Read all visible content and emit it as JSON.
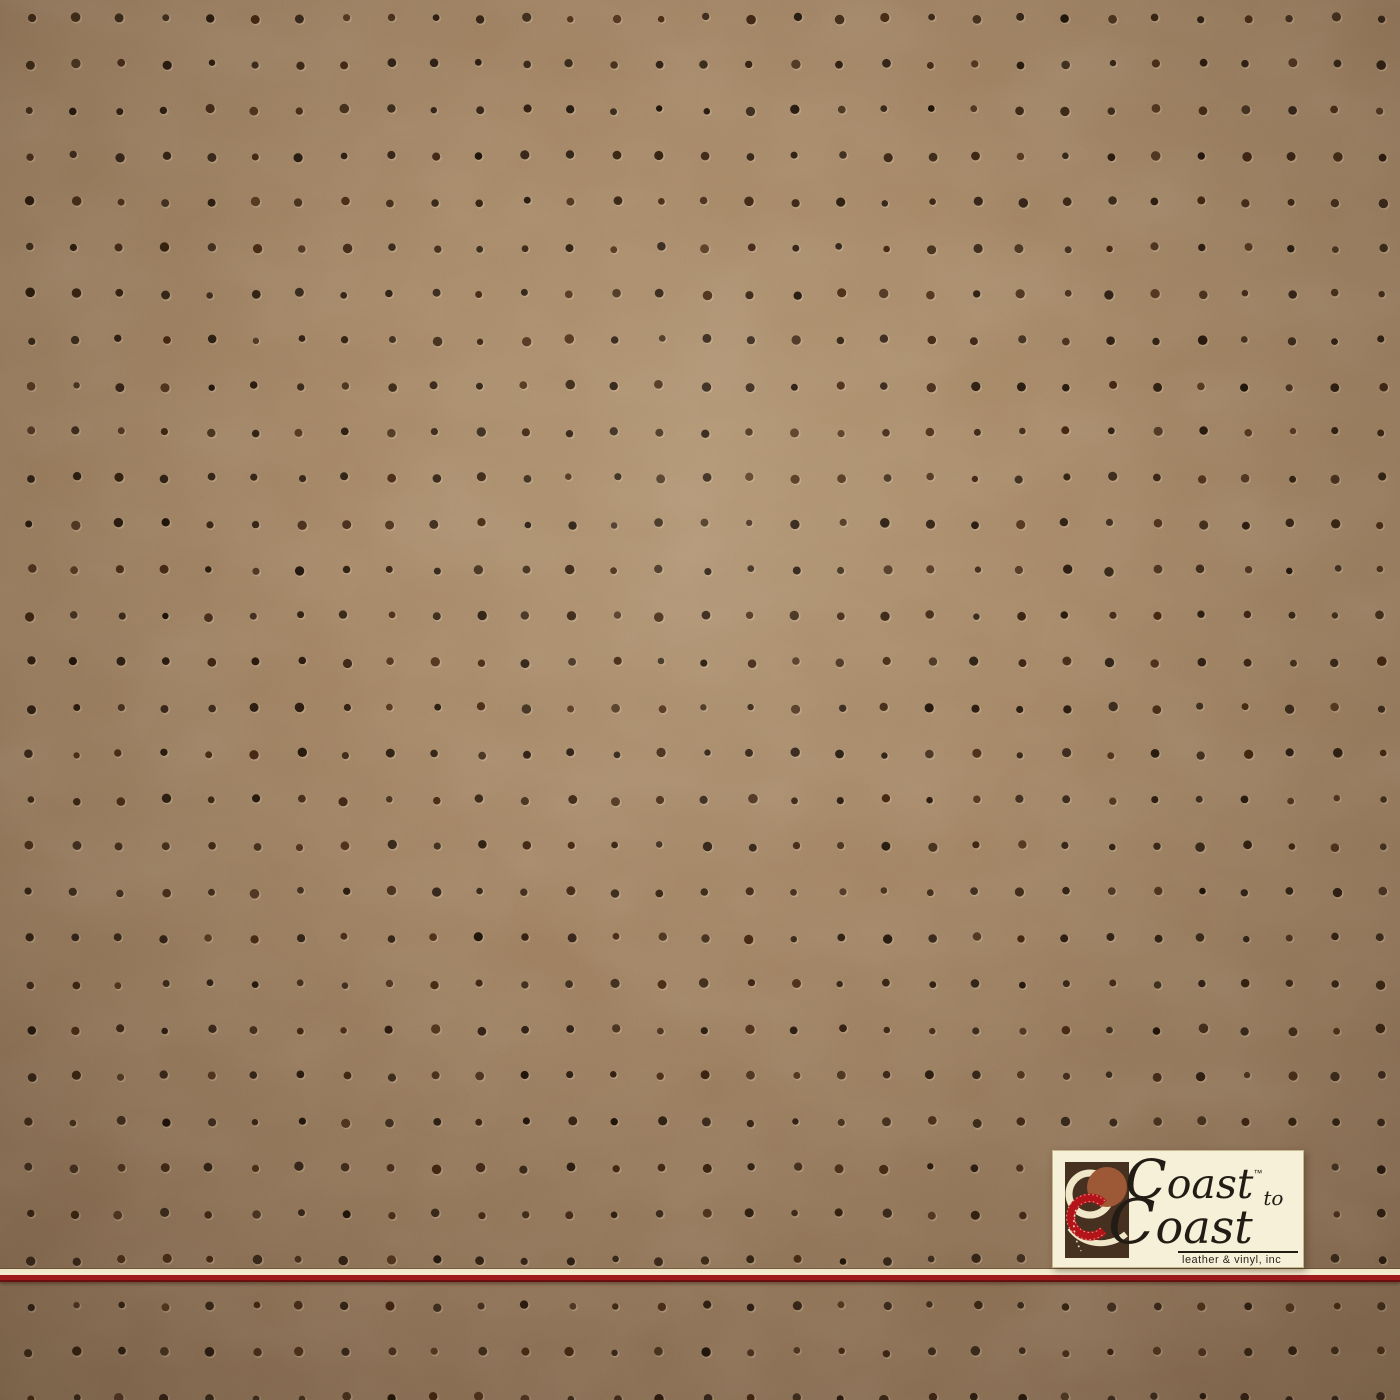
{
  "meta": {
    "description": "Product photograph of a perforated vinyl upholstery swatch: tan saddle-brown material with a regular square grid of small dark punched holes, a cream-and-red divider stripe near the bottom, and a Coast to Coast leather & vinyl, inc logo plate in the lower right corner."
  },
  "swatch": {
    "base_color": "#9d7f60",
    "highlight_color": "#a98b68",
    "mid_color": "#8f7256",
    "shadow_color": "#806549",
    "perforation": {
      "dot_color": "#281a0d",
      "dot_alt_colors": [
        "#1f1309",
        "#33200f",
        "#3c2412",
        "#2b1c10",
        "#42250f"
      ],
      "highlight_ring_color": "rgba(228,206,178,0.32)",
      "rows": 31,
      "cols": 31,
      "origin_x": 30,
      "origin_y": 18,
      "spacing_x": 45.05,
      "spacing_y": 46.0,
      "radius_min": 3.2,
      "radius_max": 4.8,
      "jitter": 2.4
    }
  },
  "divider": {
    "cream_color": "#f6eed4",
    "red_color": "#9e1a1c"
  },
  "logo": {
    "line1": "Coast",
    "trademark": "™",
    "connector": "to",
    "line2": "Coast",
    "tagline": "leather & vinyl, inc",
    "background": "#f7f0d8",
    "text_color": "#221c15",
    "emblem": {
      "background": "#46301f",
      "cream": "#f0e6c8",
      "rust": "#9d5835",
      "red": "#b3141a",
      "stitch": "#e8a08d"
    }
  }
}
